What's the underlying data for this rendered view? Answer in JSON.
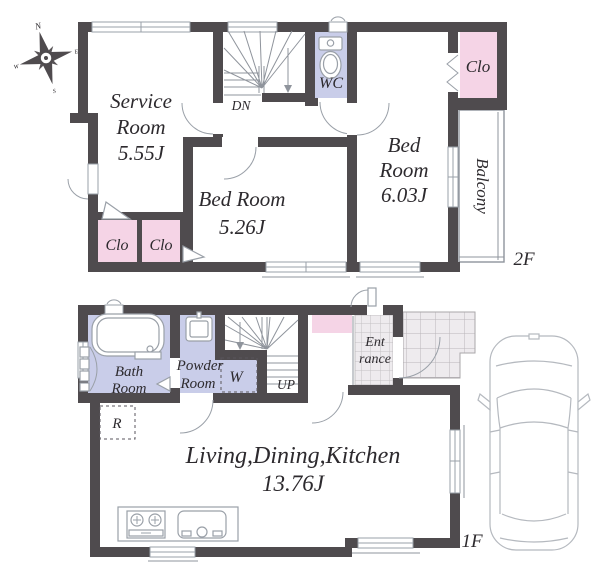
{
  "colors": {
    "wall": "#4f4b4e",
    "closet_pink": "#f5d4e6",
    "sanitary_lavender": "#c9cde9",
    "tile_fill": "#eeebee",
    "line_gray": "#9aa0a8",
    "stair_line": "#8f949c",
    "text": "#2d2a2e"
  },
  "floor2": {
    "label": "2F",
    "compass": {
      "n": "N",
      "e": "E",
      "s": "S",
      "w": "W"
    },
    "service_room": {
      "line1": "Service",
      "line2": "Room",
      "area": "5.55J"
    },
    "bed_room_1": {
      "name": "Bed Room",
      "area": "5.26J"
    },
    "bed_room_2": {
      "line1": "Bed",
      "line2": "Room",
      "area": "6.03J"
    },
    "wc_label": "WC",
    "closet_left_1": "Clo",
    "closet_left_2": "Clo",
    "closet_right": "Clo",
    "balcony_label": "Balcony",
    "stair_direction": "DN"
  },
  "floor1": {
    "label": "1F",
    "ldk": {
      "name": "Living,Dining,Kitchen",
      "area": "13.76J"
    },
    "bath_room": {
      "line1": "Bath",
      "line2": "Room"
    },
    "powder_room": {
      "line1": "Powder",
      "line2": "Room"
    },
    "entrance": {
      "line1": "Ent",
      "line2": "rance"
    },
    "washer_label": "W",
    "refrigerator_label": "R",
    "stair_direction": "UP"
  }
}
